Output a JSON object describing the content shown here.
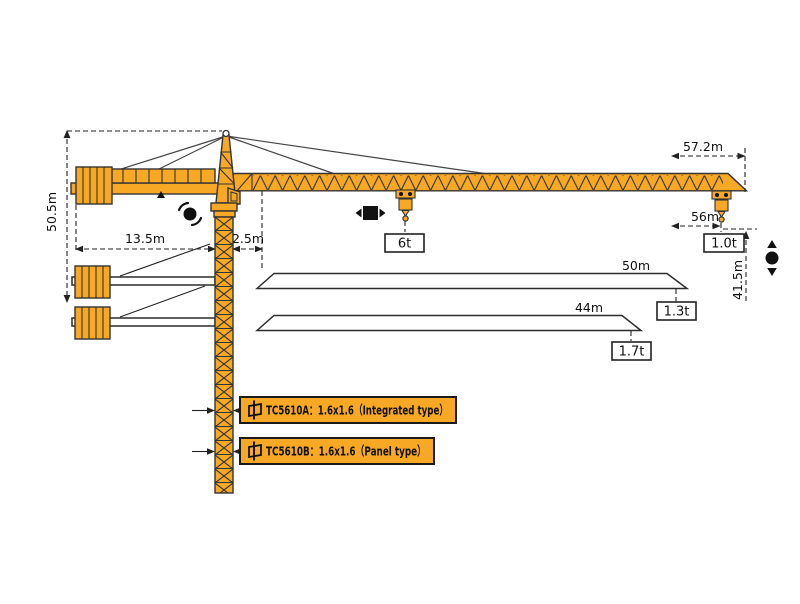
{
  "diagram": {
    "dims": {
      "total_height": "50.5m",
      "counter_jib_radius": "13.5m",
      "tower_offset": "2.5m",
      "jib_tip_radius": "57.2m",
      "max_hook_radius": "56m",
      "under_hook_height": "41.5m"
    },
    "loads": {
      "max_load": "6t",
      "tip_load_57m": "1.0t"
    },
    "jib_variants": [
      {
        "length": "50m",
        "tip_load": "1.3t"
      },
      {
        "length": "44m",
        "tip_load": "1.7t"
      }
    ],
    "mast_sections": [
      {
        "label": "TC5610A：1.6x1.6（Integrated type）"
      },
      {
        "label": "TC5610B：1.6x1.6（Panel type）"
      }
    ],
    "colors": {
      "crane_orange": "#F7A824",
      "outline": "#333333",
      "dimension_line": "#222222",
      "background": "#FFFFFF"
    }
  }
}
